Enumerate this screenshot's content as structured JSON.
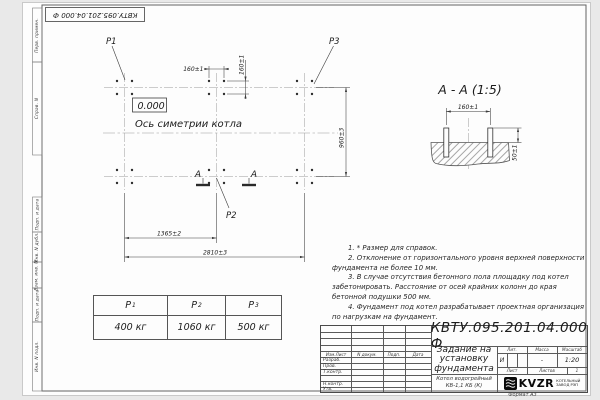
{
  "sheet": {
    "stamp_top": "КВТУ.095.201.04.000 Ф",
    "format_label": "Формат А3",
    "side_labels": [
      "Перв. примен.",
      "Справ. N",
      "Подп. и дата",
      "Инв. N дубл.",
      "Взам. инв. N",
      "Подп. и дата",
      "Инв. N подл."
    ]
  },
  "plan": {
    "label_p1": "P1",
    "label_p2": "P2",
    "label_p3": "P3",
    "level": "0.000",
    "axis_label": "Ось симетрии котла",
    "section_mark": "А",
    "dim_160h": "160±1",
    "dim_160v": "160±1",
    "dim_960": "960±3",
    "dim_1365": "1365±2",
    "dim_2810": "2810±3"
  },
  "section": {
    "title": "А - А (1:5)",
    "dim_160": "160±1",
    "dim_50": "50±1"
  },
  "notes": [
    "1. * Размер для справок.",
    "2. Отклонение от горизонтального уровня верхней поверхности фундамента не более 10 мм.",
    "3. В случае отсутствия бетонного пола площадку под котел забетонировать. Расстояние от осей крайних колонн до края бетонной подушки 500 мм.",
    "4. Фундамент под котел разрабатывает проектная организация по нагрузкам на фундамент."
  ],
  "loads_table": {
    "headers": [
      {
        "base": "P",
        "sub": "1"
      },
      {
        "base": "P",
        "sub": "2"
      },
      {
        "base": "P",
        "sub": "3"
      }
    ],
    "values": [
      "400 кг",
      "1060 кг",
      "500 кг"
    ]
  },
  "title_block": {
    "doc_number": "КВТУ.095.201.04.000 Ф",
    "title_lines": [
      "Задание на",
      "установку",
      "фундамента"
    ],
    "product_lines": [
      "Котел водогрейный",
      "КВ-1,1 КБ (К)"
    ],
    "col_izm": "Изм.Лист",
    "col_doc": "N докум.",
    "col_podp": "Подп.",
    "col_data": "Дата",
    "rows": [
      "Разраб.",
      "Пров.",
      "Т.контр.",
      "",
      "Н.контр.",
      "Утв."
    ],
    "lit_label": "Лит.",
    "mass_label": "Масса",
    "scale_label": "Масштаб",
    "lit_value": "И",
    "mass_value": "-",
    "scale_value": "1:20",
    "sheet_label": "Лист",
    "sheets_label": "Листов",
    "sheets_value": "1",
    "logo_text": "KVZR",
    "logo_caption_lines": [
      "КОТЕЛЬНЫЙ",
      "ЗАВОД РЭП"
    ]
  }
}
